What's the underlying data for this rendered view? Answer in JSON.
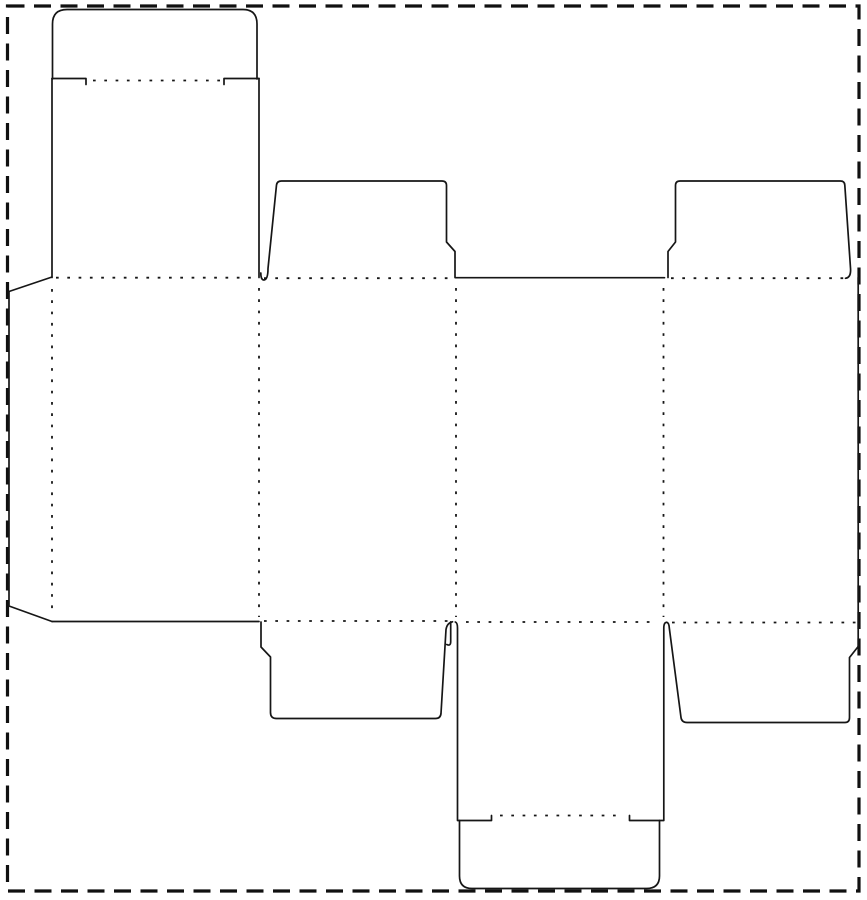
{
  "canvas": {
    "width": 867,
    "height": 900,
    "background_color": "#ffffff"
  },
  "page_border": {
    "type": "dashed-rectangle",
    "x": 7.5,
    "y": 6,
    "width": 851.5,
    "height": 885,
    "stroke_color": "#101010",
    "stroke_width": 3.2,
    "dash_pattern": "17 9.5"
  },
  "dieline": {
    "description": "flat box die-cut template: tuck-end carton with glue flap, four body panels, dust flaps and tuck covers",
    "cut_line_color": "#161616",
    "cut_line_width": 1.7,
    "fold_line_color": "#161616",
    "fold_line_width": 1.8,
    "fold_dash_pattern": "2.7 8.6",
    "cut_paths": [
      {
        "name": "top-tuck-flap-outline",
        "d": "M 52.5 79 L 52.5 24 Q 52.5 9.5 67 9.5 L 243 9.5 Q 257 9.5 257 24 L 257 79"
      },
      {
        "name": "top-tuck-shoulder-left",
        "d": "M 52 78.5 L 86 78.5 L 86 84.5"
      },
      {
        "name": "top-tuck-shoulder-right",
        "d": "M 224 84.5 L 224 78.5 L 259 78.5"
      },
      {
        "name": "top-cover-panel-left-edge",
        "d": "M 52 78.5 L 52 277.5"
      },
      {
        "name": "top-cover-panel-right-edge",
        "d": "M 259 78.5 L 259 277.5"
      },
      {
        "name": "glue-flap-outline",
        "d": "M 52 277 L 9 291.5 L 9 606 L 52 621.5"
      },
      {
        "name": "panel1-bottom-cut",
        "d": "M 52 621.5 L 259 621.5"
      },
      {
        "name": "panel3-top-cut",
        "d": "M 455.5 277.7 L 664.5 277.7"
      },
      {
        "name": "top-dust-flap-left-outline",
        "d": "M 268 268.5 Q 268 279.5 264 280 Q 260.8 280 260.8 273 M 268 268.5 L 276.5 185 Q 277 181 281.5 181 L 442 181 Q 446.5 181 446.5 185.5 L 446.5 242 L 455 251.5 L 455 277.5"
      },
      {
        "name": "top-dust-flap-right-outline",
        "d": "M 668 277.5 L 668 251.5 L 675.5 242 L 675.5 185.5 Q 675.5 181 680 181 L 840.5 181 Q 844.5 181 844.8 185 L 850.5 268 Q 851.3 277.5 845.5 278.3"
      },
      {
        "name": "panel4-right-edge",
        "d": "M 858.2 277.5 L 858.2 646.5"
      },
      {
        "name": "bottom-dust-flap-left-outline",
        "d": "M 261 622 L 261 647 L 270.5 657 L 270.5 712.5 Q 270.5 718.5 276.5 718.5 L 435.5 718.5 Q 440.5 718.5 441 713.5 L 446 629.5 Q 447 623 452.5 621.8"
      },
      {
        "name": "bottom-cover-left-slit",
        "d": "M 450.7 621.8 L 450.7 641.5 Q 450.7 646.5 446.8 644.5"
      },
      {
        "name": "bottom-dust-flap-right-outline",
        "d": "M 666.8 622.3 Q 669 622.8 669.3 628 L 681 717.5 Q 681.7 722.5 687 722.5 L 845 722.5 Q 849.5 722.5 849.5 717.5 L 849.5 657.5 L 858.2 646.5"
      },
      {
        "name": "bottom-cover-left-edge",
        "d": "M 455.3 622 Q 457.5 622.8 457.5 628 L 457.5 820.5 L 491.5 820.5 L 491.5 815.5"
      },
      {
        "name": "bottom-cover-right-edge",
        "d": "M 666.8 622.3 Q 663.8 622.3 663.8 628 L 663.8 820.5 L 629.5 820.5 L 629.5 815.5"
      },
      {
        "name": "bottom-tuck-flap-outline",
        "d": "M 459.5 820.5 L 459.5 876 Q 459.5 888.5 472 888.5 L 646.5 888.5 Q 659.5 888.5 659.5 876 L 659.5 820.5"
      }
    ],
    "fold_lines": [
      {
        "name": "top-tuck-fold",
        "x1": 93,
        "y1": 80.5,
        "x2": 221,
        "y2": 80.5
      },
      {
        "name": "panel1-top-fold",
        "x1": 56,
        "y1": 277.7,
        "x2": 258,
        "y2": 277.7
      },
      {
        "name": "top-dust-flap-left-fold",
        "x1": 264,
        "y1": 278.2,
        "x2": 454,
        "y2": 278.2
      },
      {
        "name": "top-dust-flap-right-fold",
        "x1": 671,
        "y1": 278.2,
        "x2": 846,
        "y2": 278.2
      },
      {
        "name": "vertical-fold-glue",
        "x1": 52,
        "y1": 289,
        "x2": 52,
        "y2": 616
      },
      {
        "name": "vertical-fold-panel1-2",
        "x1": 259,
        "y1": 288,
        "x2": 259,
        "y2": 617
      },
      {
        "name": "vertical-fold-panel2-3",
        "x1": 456,
        "y1": 288,
        "x2": 456,
        "y2": 617
      },
      {
        "name": "vertical-fold-panel3-4",
        "x1": 663.5,
        "y1": 288,
        "x2": 663.5,
        "y2": 617
      },
      {
        "name": "bottom-dust-flap-left-fold",
        "x1": 264,
        "y1": 621,
        "x2": 454,
        "y2": 621
      },
      {
        "name": "panel3-bottom-fold",
        "x1": 466,
        "y1": 622,
        "x2": 657,
        "y2": 622
      },
      {
        "name": "bottom-dust-flap-right-fold",
        "x1": 672,
        "y1": 622.5,
        "x2": 856,
        "y2": 622.5
      },
      {
        "name": "bottom-tuck-fold",
        "x1": 500,
        "y1": 815.5,
        "x2": 619,
        "y2": 815.5
      }
    ]
  }
}
